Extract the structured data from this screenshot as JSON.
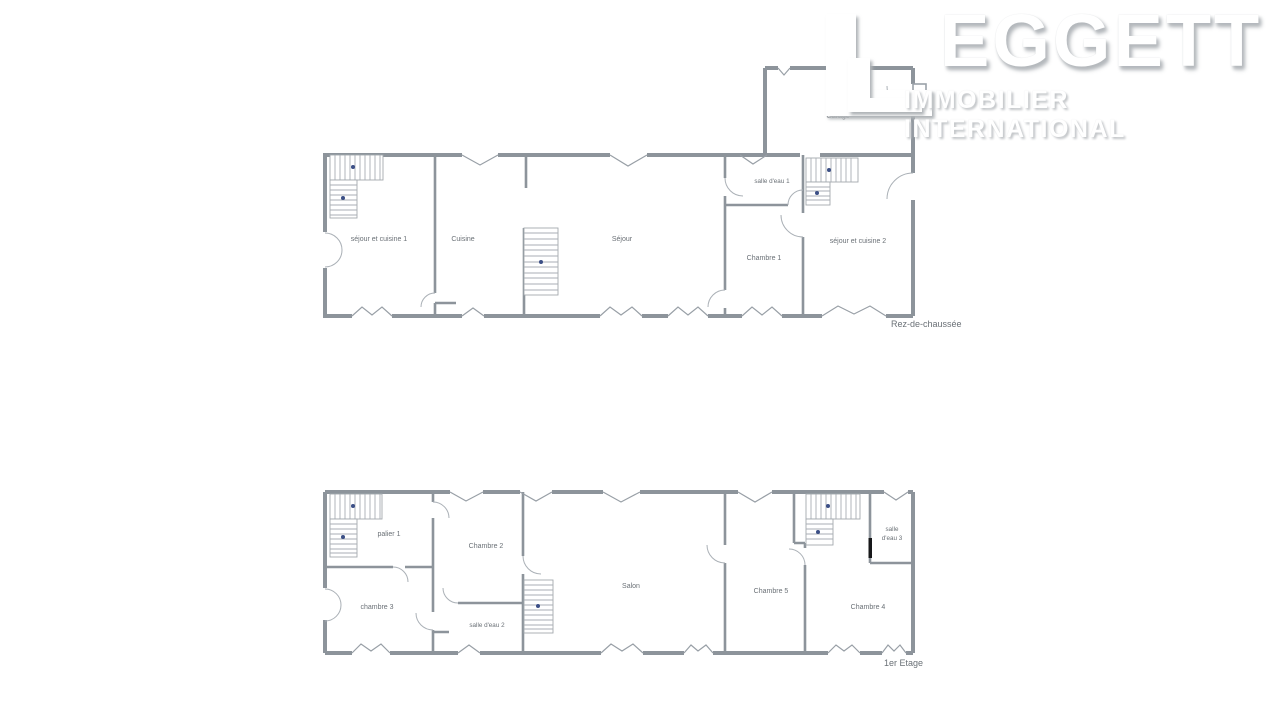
{
  "logo": {
    "brand_initial": "L",
    "brand_rest": "EGGETT",
    "tagline": "IMMOBILIER INTERNATIONAL"
  },
  "ground_floor": {
    "floor_label": "Rez-de-chaussée",
    "rooms": {
      "sejour_cuisine_1": "séjour et cuisine 1",
      "cuisine": "Cuisine",
      "sejour": "Séjour",
      "salle_eau_1": "salle d'eau 1",
      "chambre_1": "Chambre 1",
      "sejour_cuisine_2": "séjour et cuisine 2",
      "garage": "Garage"
    }
  },
  "first_floor": {
    "floor_label": "1er Etage",
    "rooms": {
      "palier_1": "palier 1",
      "chambre_2": "Chambre 2",
      "chambre_3": "chambre 3",
      "salle_eau_2": "salle d'eau 2",
      "salon": "Salon",
      "chambre_5": "Chambre 5",
      "salle_eau_3_line1": "salle",
      "salle_eau_3_line2": "d'eau 3",
      "chambre_4": "Chambre 4"
    }
  },
  "colors": {
    "wall": "#8d949b",
    "label_text": "#6a7076",
    "stair_dot": "#3c4f86",
    "background": "#ffffff"
  }
}
